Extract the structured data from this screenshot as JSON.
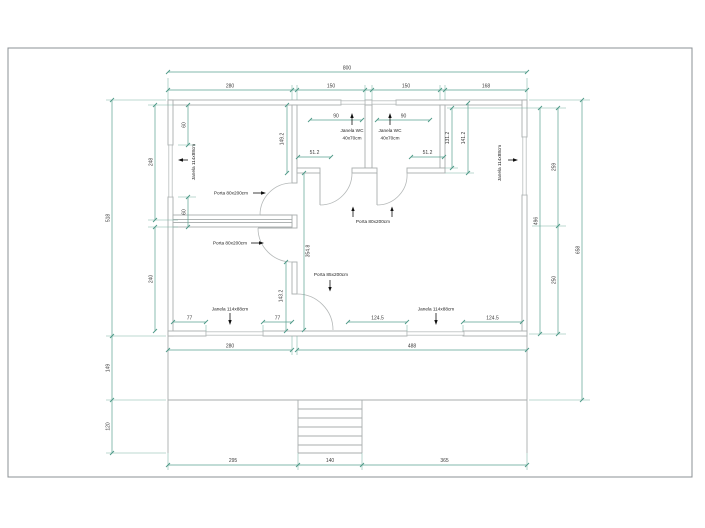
{
  "drawing": {
    "type": "architectural-floor-plan",
    "language": "pt",
    "colors": {
      "dimension_line": "#5aa391",
      "wall_line": "#a8adad",
      "text": "#333333",
      "page_border": "#8b9094",
      "background": "#ffffff"
    },
    "dims": {
      "d800": "800",
      "d280_top": "280",
      "d150_a": "150",
      "d150_b": "150",
      "d168": "168",
      "d518": "518",
      "d149": "149",
      "d120": "120",
      "d248": "248",
      "d240": "240",
      "d60_a": "60",
      "d60_b": "60",
      "d496": "496",
      "d259": "259",
      "d250": "250",
      "d658": "658",
      "d131": "131.2",
      "d141": "141.2",
      "d280_bot": "280",
      "d488": "488",
      "d77_a": "77",
      "d77_b": "77",
      "d124_a": "124.5",
      "d124_b": "124.5",
      "d295": "295",
      "d140": "140",
      "d365": "365",
      "d90_a": "90",
      "d90_b": "90",
      "d51_a": "51.2",
      "d51_b": "51.2",
      "d149_2": "149.2",
      "d354_8": "354.8",
      "d143_2": "143.2"
    },
    "labels": {
      "window_left": "Janela 114x88cm",
      "window_right": "Janela 114x88cm",
      "window_room2": "Janela 114x88cm",
      "window_living": "Janela 114x88cm",
      "wc1_line1": "Janela WC",
      "wc1_line2": "40x70cm",
      "wc2_line1": "Janela WC",
      "wc2_line2": "40x70cm",
      "door_room1": "Porta 80x200cm",
      "door_room2": "Porta 80x200cm",
      "door_wc": "Porta 80x200cm",
      "door_living": "Porta 85x200cm"
    }
  }
}
